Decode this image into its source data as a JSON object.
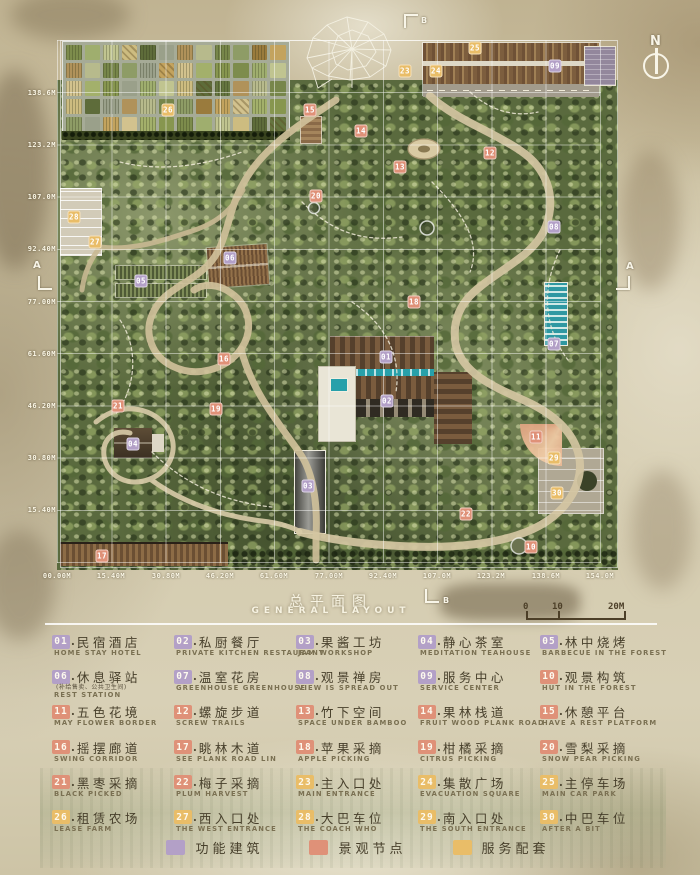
{
  "title": {
    "zh": "总平面图",
    "en": "GENERAL LAYOUT"
  },
  "compass_label": "N",
  "section_markers": {
    "top": "B",
    "bottom": "B",
    "left": "A",
    "right": "A"
  },
  "scale_bar": {
    "ticks": [
      "0",
      "10",
      "20M"
    ]
  },
  "axis": {
    "left": [
      {
        "label": "138.6M",
        "y": 93
      },
      {
        "label": "123.2M",
        "y": 145
      },
      {
        "label": "107.0M",
        "y": 197
      },
      {
        "label": "92.40M",
        "y": 249
      },
      {
        "label": "77.00M",
        "y": 302
      },
      {
        "label": "61.60M",
        "y": 354
      },
      {
        "label": "46.20M",
        "y": 406
      },
      {
        "label": "30.80M",
        "y": 458
      },
      {
        "label": "15.40M",
        "y": 510
      }
    ],
    "bottom": [
      {
        "label": "00.00M",
        "x": 57
      },
      {
        "label": "15.40M",
        "x": 111
      },
      {
        "label": "30.80M",
        "x": 166
      },
      {
        "label": "46.20M",
        "x": 220
      },
      {
        "label": "61.60M",
        "x": 274
      },
      {
        "label": "77.00M",
        "x": 329
      },
      {
        "label": "92.40M",
        "x": 383
      },
      {
        "label": "107.0M",
        "x": 437
      },
      {
        "label": "123.2M",
        "x": 491
      },
      {
        "label": "138.6M",
        "x": 546
      },
      {
        "label": "154.0M",
        "x": 600
      }
    ]
  },
  "map_labels": [
    {
      "num": "01",
      "x": 386,
      "y": 357,
      "cat": "building"
    },
    {
      "num": "02",
      "x": 387,
      "y": 401,
      "cat": "building"
    },
    {
      "num": "03",
      "x": 308,
      "y": 486,
      "cat": "building"
    },
    {
      "num": "04",
      "x": 133,
      "y": 444,
      "cat": "building"
    },
    {
      "num": "05",
      "x": 141,
      "y": 281,
      "cat": "building"
    },
    {
      "num": "06",
      "x": 230,
      "y": 258,
      "cat": "building"
    },
    {
      "num": "07",
      "x": 554,
      "y": 344,
      "cat": "building"
    },
    {
      "num": "08",
      "x": 554,
      "y": 227,
      "cat": "building"
    },
    {
      "num": "09",
      "x": 555,
      "y": 66,
      "cat": "building"
    },
    {
      "num": "10",
      "x": 531,
      "y": 547,
      "cat": "landscape"
    },
    {
      "num": "11",
      "x": 536,
      "y": 437,
      "cat": "landscape"
    },
    {
      "num": "12",
      "x": 490,
      "y": 153,
      "cat": "landscape"
    },
    {
      "num": "13",
      "x": 400,
      "y": 167,
      "cat": "landscape"
    },
    {
      "num": "14",
      "x": 361,
      "y": 131,
      "cat": "landscape"
    },
    {
      "num": "15",
      "x": 310,
      "y": 110,
      "cat": "landscape"
    },
    {
      "num": "16",
      "x": 224,
      "y": 359,
      "cat": "landscape"
    },
    {
      "num": "17",
      "x": 102,
      "y": 556,
      "cat": "landscape"
    },
    {
      "num": "18",
      "x": 414,
      "y": 302,
      "cat": "landscape"
    },
    {
      "num": "19",
      "x": 216,
      "y": 409,
      "cat": "landscape"
    },
    {
      "num": "20",
      "x": 316,
      "y": 196,
      "cat": "landscape"
    },
    {
      "num": "21",
      "x": 118,
      "y": 406,
      "cat": "landscape"
    },
    {
      "num": "22",
      "x": 466,
      "y": 514,
      "cat": "landscape"
    },
    {
      "num": "23",
      "x": 405,
      "y": 71,
      "cat": "service"
    },
    {
      "num": "24",
      "x": 436,
      "y": 71,
      "cat": "service"
    },
    {
      "num": "25",
      "x": 475,
      "y": 48,
      "cat": "service"
    },
    {
      "num": "26",
      "x": 168,
      "y": 110,
      "cat": "service"
    },
    {
      "num": "27",
      "x": 95,
      "y": 242,
      "cat": "service"
    },
    {
      "num": "28",
      "x": 74,
      "y": 217,
      "cat": "service"
    },
    {
      "num": "29",
      "x": 554,
      "y": 458,
      "cat": "service"
    },
    {
      "num": "30",
      "x": 557,
      "y": 493,
      "cat": "service"
    }
  ],
  "legend": {
    "items": [
      {
        "num": "01",
        "zh": "民宿酒店",
        "en": "HOME STAY HOTEL",
        "cat": "building"
      },
      {
        "num": "02",
        "zh": "私厨餐厅",
        "en": "PRIVATE KITCHEN RESTAURANT",
        "cat": "building"
      },
      {
        "num": "03",
        "zh": "果酱工坊",
        "en": "JAM WORKSHOP",
        "cat": "building"
      },
      {
        "num": "04",
        "zh": "静心茶室",
        "en": "MEDITATION TEAHOUSE",
        "cat": "building"
      },
      {
        "num": "05",
        "zh": "林中烧烤",
        "en": "BARBECUE IN THE FOREST",
        "cat": "building"
      },
      {
        "num": "06",
        "zh": "休息驿站",
        "sub": "(补给售卖、公共卫生间)",
        "en": "REST STATION",
        "cat": "building"
      },
      {
        "num": "07",
        "zh": "温室花房",
        "en": "GREENHOUSE GREENHOUSE",
        "cat": "building"
      },
      {
        "num": "08",
        "zh": "观景禅房",
        "en": "VIEW IS SPREAD OUT",
        "cat": "building"
      },
      {
        "num": "09",
        "zh": "服务中心",
        "en": "SERVICE CENTER",
        "cat": "building"
      },
      {
        "num": "10",
        "zh": "观景构筑",
        "en": "HUT IN THE FOREST",
        "cat": "landscape"
      },
      {
        "num": "11",
        "zh": "五色花境",
        "en": "MAY FLOWER BORDER",
        "cat": "landscape"
      },
      {
        "num": "12",
        "zh": "螺旋步道",
        "en": "SCREW TRAILS",
        "cat": "landscape"
      },
      {
        "num": "13",
        "zh": "竹下空间",
        "en": "SPACE UNDER BAMBOO",
        "cat": "landscape"
      },
      {
        "num": "14",
        "zh": "果林栈道",
        "en": "FRUIT WOOD PLANK ROAD",
        "cat": "landscape"
      },
      {
        "num": "15",
        "zh": "休憩平台",
        "en": "HAVE A REST PLATFORM",
        "cat": "landscape"
      },
      {
        "num": "16",
        "zh": "摇摆廊道",
        "en": "SWING CORRIDOR",
        "cat": "landscape"
      },
      {
        "num": "17",
        "zh": "眺林木道",
        "en": "SEE PLANK ROAD LIN",
        "cat": "landscape"
      },
      {
        "num": "18",
        "zh": "苹果采摘",
        "en": "APPLE PICKING",
        "cat": "landscape"
      },
      {
        "num": "19",
        "zh": "柑橘采摘",
        "en": "CITRUS PICKING",
        "cat": "landscape"
      },
      {
        "num": "20",
        "zh": "雪梨采摘",
        "en": "SNOW PEAR PICKING",
        "cat": "landscape"
      },
      {
        "num": "21",
        "zh": "黑枣采摘",
        "en": "BLACK PICKED",
        "cat": "landscape"
      },
      {
        "num": "22",
        "zh": "梅子采摘",
        "en": "PLUM HARVEST",
        "cat": "landscape"
      },
      {
        "num": "23",
        "zh": "主入口处",
        "en": "MAIN ENTRANCE",
        "cat": "service"
      },
      {
        "num": "24",
        "zh": "集散广场",
        "en": "EVACUATION SQUARE",
        "cat": "service"
      },
      {
        "num": "25",
        "zh": "主停车场",
        "en": "MAIN CAR PARK",
        "cat": "service"
      },
      {
        "num": "26",
        "zh": "租赁农场",
        "en": "LEASE FARM",
        "cat": "service"
      },
      {
        "num": "27",
        "zh": "西入口处",
        "en": "THE WEST ENTRANCE",
        "cat": "service"
      },
      {
        "num": "28",
        "zh": "大巴车位",
        "en": "THE COACH WHO",
        "cat": "service"
      },
      {
        "num": "29",
        "zh": "南入口处",
        "en": "THE SOUTH ENTRANCE",
        "cat": "service"
      },
      {
        "num": "30",
        "zh": "中巴车位",
        "en": "AFTER A BIT",
        "cat": "service"
      }
    ]
  },
  "category_key": [
    {
      "label": "功能建筑",
      "cat": "building",
      "color": "#b3a0c7"
    },
    {
      "label": "景观节点",
      "cat": "landscape",
      "color": "#df9178"
    },
    {
      "label": "服务配套",
      "cat": "service",
      "color": "#e9bd68"
    }
  ],
  "colors": {
    "building": "#b3a0c7",
    "landscape": "#df9178",
    "service": "#e9bd68"
  }
}
